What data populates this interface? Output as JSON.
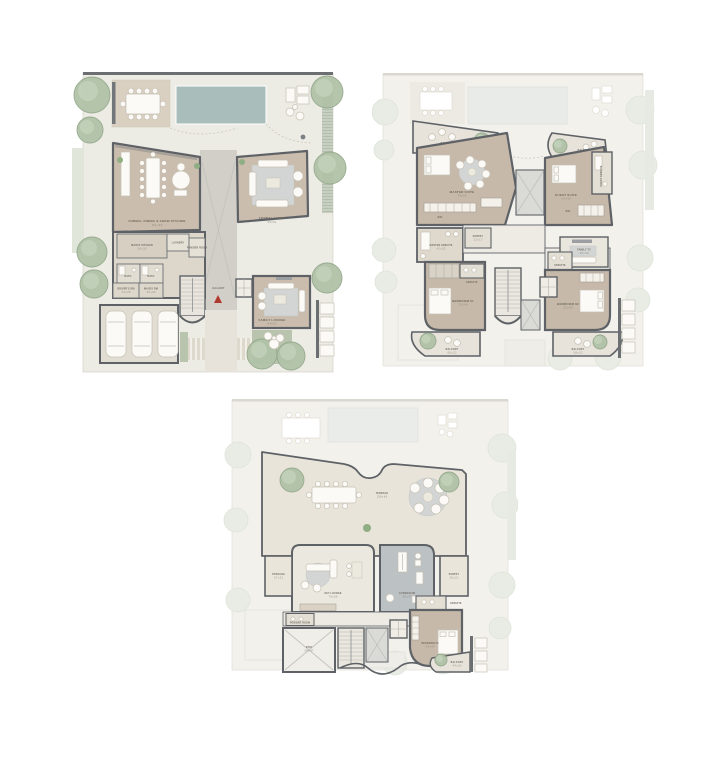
{
  "colors": {
    "background": "#ffffff",
    "site": "#ecebe4",
    "ghost_site": "#f2f1ec",
    "wall": "#5e6266",
    "floor_main": "#cabdad",
    "floor_secondary": "#ddd6ca",
    "terrace_floor": "#e8e4d9",
    "pool": "#a9bdbb",
    "tree_green": "#b0c2a7",
    "gym_floor": "#bcc1c3",
    "rug_gray": "#d2d5d4",
    "grass": "#b9c4ae",
    "entry_accent_red": "#b0392e",
    "label_text": "#6f6a60"
  },
  "ground_floor": {
    "formal_dining": {
      "name": "FORMAL DINING & SHOW KITCHEN",
      "dims": "10.1 x 6.8"
    },
    "formal_living": {
      "name": "FORMAL LIVING",
      "dims": "6.6 x 6.1"
    },
    "family_lounge": {
      "name": "FAMILY LOUNGE",
      "dims": "6.4 x 6.0"
    },
    "maids_kitchen": {
      "name": "MAID'S KITCHEN",
      "dims": "3.6 x 3.2"
    },
    "laundry": {
      "name": "LAUNDRY"
    },
    "powder_room": {
      "name": "POWDER ROOM"
    },
    "bath_1": {
      "name": "BATH"
    },
    "bath_2": {
      "name": "BATH"
    },
    "drivers_room": {
      "name": "DRIVER'S RM",
      "dims": "3.4 x 2.8"
    },
    "maids_room": {
      "name": "MAID'S RM",
      "dims": "3.4 x 2.8"
    },
    "gallery": {
      "name": "GALLERY"
    }
  },
  "first_floor": {
    "balcony_tl": {
      "name": "BALCONY",
      "dims": "7.4 x 2.5"
    },
    "balcony_tr": {
      "name": "BALCONY",
      "dims": "6.2 x 2.4"
    },
    "master_suite": {
      "name": "MASTER SUITE",
      "dims": "7.6 x 6.4"
    },
    "master_wic": {
      "name": "WIC"
    },
    "master_ensuite": {
      "name": "MASTER ENSUITE",
      "dims": "4.1 x 3.2"
    },
    "guest_suite": {
      "name": "GUEST SUITE",
      "dims": "5.4 x 4.6"
    },
    "guest_ensuite": {
      "name": "GUEST ENSUITE"
    },
    "guest_wic": {
      "name": "WIC"
    },
    "pantry": {
      "name": "PANTRY",
      "dims": "2.1 x 1.7"
    },
    "family_tv": {
      "name": "FAMILY TV",
      "dims": "4.9 x 3.9"
    },
    "bedroom_01": {
      "name": "BEDROOM 01",
      "dims": "5.2 x 4.4"
    },
    "bedroom_01_ensuite": {
      "name": "ENSUITE"
    },
    "bedroom_02": {
      "name": "BEDROOM 02",
      "dims": "5.2 x 4.3"
    },
    "bedroom_02_ensuite": {
      "name": "ENSUITE"
    },
    "balcony_bl": {
      "name": "BALCONY",
      "dims": "6.0 x 2.2"
    },
    "balcony_br": {
      "name": "BALCONY",
      "dims": "5.8 x 2.2"
    }
  },
  "second_floor": {
    "terrace": {
      "name": "TERRACE",
      "dims": "15.8 x 6.6"
    },
    "sky_lounge": {
      "name": "SKY LOUNGE",
      "dims": "7.6 x 5.6"
    },
    "gym": {
      "name": "GYMNASIUM",
      "dims": "5.6 x 4.7"
    },
    "storage": {
      "name": "STORAGE",
      "dims": "2.7 x 2.1"
    },
    "pantry": {
      "name": "PANTRY",
      "dims": "2.6 x 2.1"
    },
    "powder_room": {
      "name": "POWDER ROOM"
    },
    "void": {
      "name": "VOID",
      "dims": "5.6 x 4.7"
    },
    "bedroom_03": {
      "name": "BEDROOM 03",
      "dims": "5.4 x 4.4"
    },
    "bedroom_03_ensuite": {
      "name": "ENSUITE"
    },
    "balcony": {
      "name": "BALCONY",
      "dims": "4.4 x 2.6"
    }
  }
}
